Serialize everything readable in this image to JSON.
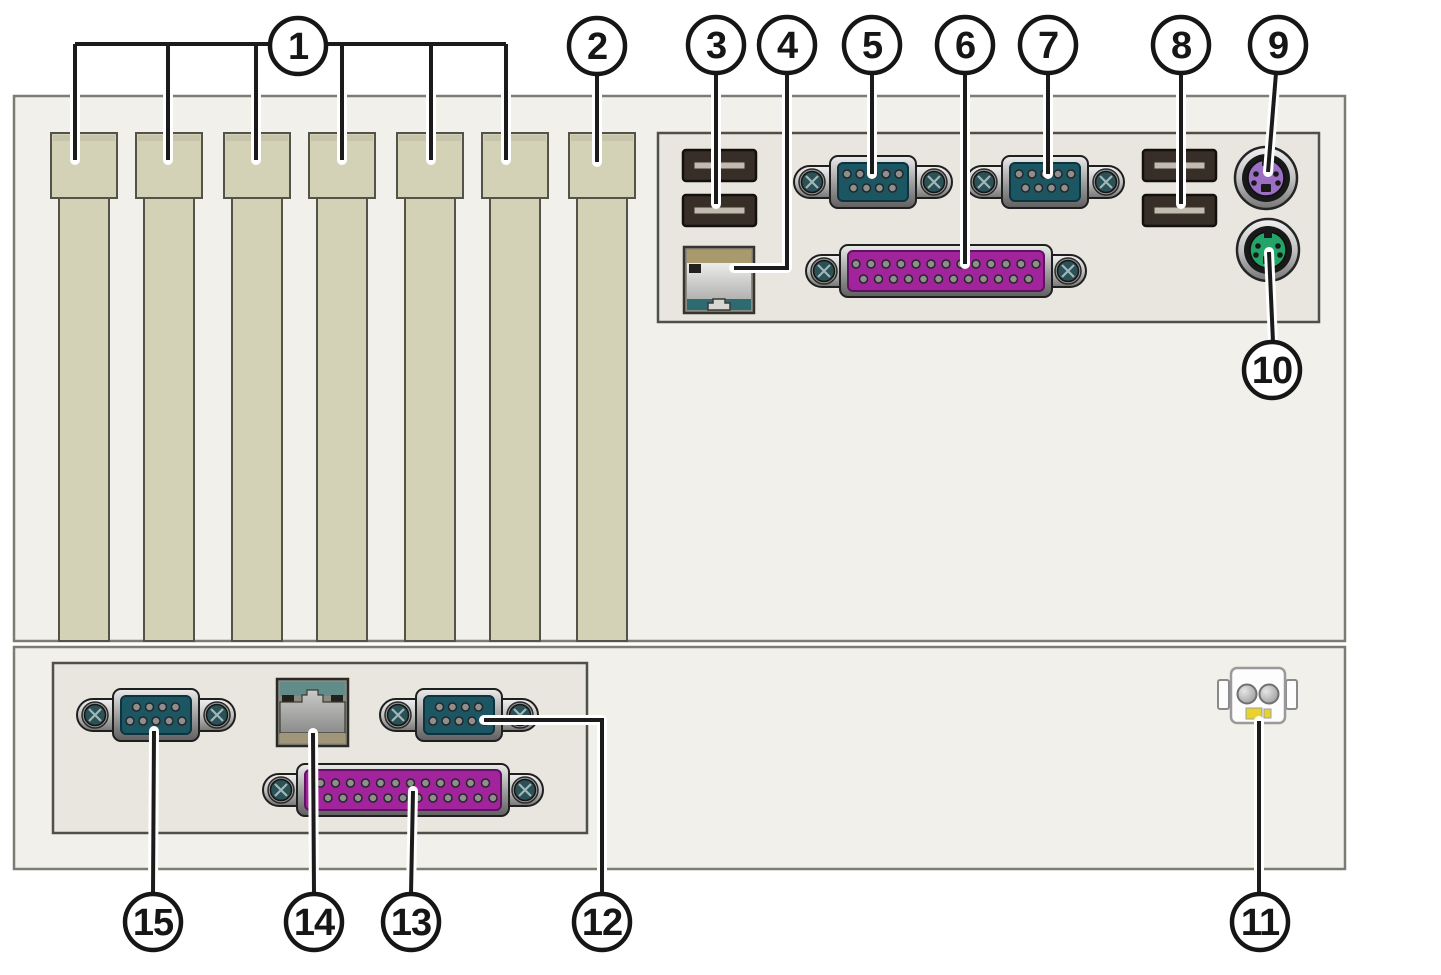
{
  "diagram": {
    "description": "Rear panel of a computer chassis with numbered callouts pointing to ports and slots",
    "background": "#ffffff"
  },
  "colors": {
    "chassis_fill": "#f1f0ea",
    "chassis_border": "#7d7c74",
    "panel_fill": "#e8e6df",
    "panel_border": "#514f49",
    "slot_fill": "#d4d2b6",
    "slot_border": "#54534a",
    "slot_lip": "#c6c4aa",
    "leader_line": "#1b1b1b",
    "leader_casing": "#ffffff",
    "callout_fill": "#ffffff",
    "callout_stroke": "#161616",
    "metal_light": "#efefef",
    "metal_mid": "#b9b9b9",
    "metal_dark": "#6e6e6e",
    "serial_teal": "#1c5663",
    "screw_teal": "#2b5056",
    "screw_cross": "#9fb8ba",
    "parallel_magenta": "#a2249c",
    "parallel_border": "#5f1260",
    "usb_body": "#362e27",
    "usb_border": "#14100c",
    "usb_tab": "#c2bbb0",
    "rj45_frame": "#8b8b81",
    "rj45_tan": "#a89a6c",
    "rj45_teal_dark": "#2e6b70",
    "rj45_teal_sage": "#618c89",
    "rj45_tan_muted": "#a2967a",
    "rj45_dark_square": "#23211d",
    "rj45_notch": "#d6d6d4",
    "ps2_keyboard": "#9a6fc4",
    "ps2_mouse": "#22a566",
    "ps2_dark": "#191919",
    "power_body": "#fdfdfd",
    "power_pin_border": "#707070",
    "power_key_yellow": "#e8d22e",
    "pin_fill": "#8f8f8f",
    "pin_stroke": "#262626"
  },
  "callouts": [
    {
      "label": "1",
      "target": "expansion-slots"
    },
    {
      "label": "2",
      "target": "expansion-slot"
    },
    {
      "label": "3",
      "target": "usb-ports"
    },
    {
      "label": "4",
      "target": "ethernet-port"
    },
    {
      "label": "5",
      "target": "serial-port"
    },
    {
      "label": "6",
      "target": "parallel-port"
    },
    {
      "label": "7",
      "target": "serial-port"
    },
    {
      "label": "8",
      "target": "usb-ports"
    },
    {
      "label": "9",
      "target": "ps2-keyboard-port"
    },
    {
      "label": "10",
      "target": "ps2-mouse-port"
    },
    {
      "label": "11",
      "target": "power-connector"
    },
    {
      "label": "12",
      "target": "serial-port"
    },
    {
      "label": "13",
      "target": "parallel-port"
    },
    {
      "label": "14",
      "target": "ethernet-port"
    },
    {
      "label": "15",
      "target": "serial-port"
    }
  ]
}
